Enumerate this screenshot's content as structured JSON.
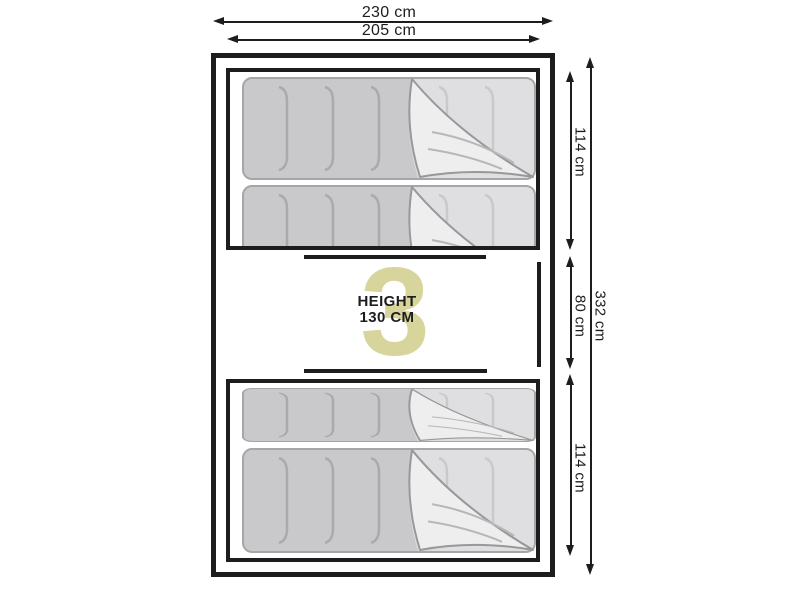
{
  "dimensions": {
    "width_outer": "230 cm",
    "width_inner": "205 cm",
    "height_total": "332 cm",
    "section_top": "114 cm",
    "section_middle": "80 cm",
    "section_bottom": "114 cm"
  },
  "center_label": {
    "line1": "HEIGHT",
    "line2": "130 CM"
  },
  "watermark": {
    "text": "3",
    "color": "#d7d49c"
  },
  "icons": {
    "sleeping_bag": "sleeping-bag-illustration"
  },
  "colors": {
    "line": "#1d1d1d",
    "background": "#ffffff",
    "bag_body": "#c9c9cb",
    "bag_light": "#dfdfe1",
    "bag_flap": "#eeeeef"
  }
}
